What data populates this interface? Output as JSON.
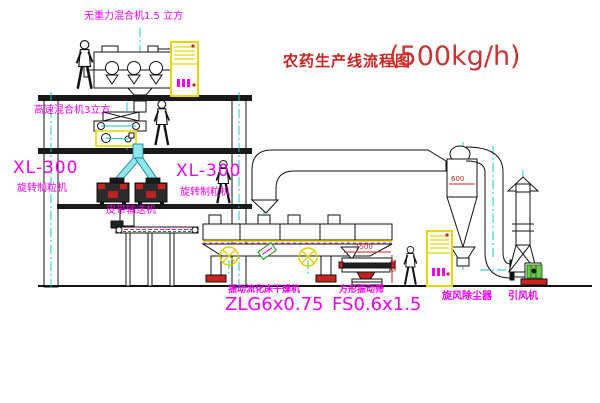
{
  "title": {
    "zh": "农药生产线流程图",
    "capacity": "(500kg/h)"
  },
  "labels": {
    "gravity_mixer": "无重力混合机1.5 立方",
    "high_speed_mixer": "高速混合机3立方",
    "granulator_left_model": "XL-300",
    "granulator_left_name": "旋转制粒机",
    "granulator_right_model": "XL-300",
    "granulator_right_name": "旋转制粒机",
    "belt_conveyor": "皮带输送机",
    "dryer_name": "振动流化床干燥机",
    "dryer_model": "ZLG6x0.75",
    "screen_name": "方形振动筛",
    "screen_model": "FS0.6x1.5",
    "cyclone": "旋风除尘器",
    "fan": "引风机"
  },
  "dimensions": {
    "screen_length": "1500",
    "screen_height": "545",
    "cyclone_width": "600"
  },
  "colors": {
    "label_magenta": "#f200f2",
    "title_red": "#cc2222",
    "centerline_cyan": "#00c8c8",
    "cabinet_yellow": "#e8d800",
    "dimension_red": "#cc2222"
  }
}
